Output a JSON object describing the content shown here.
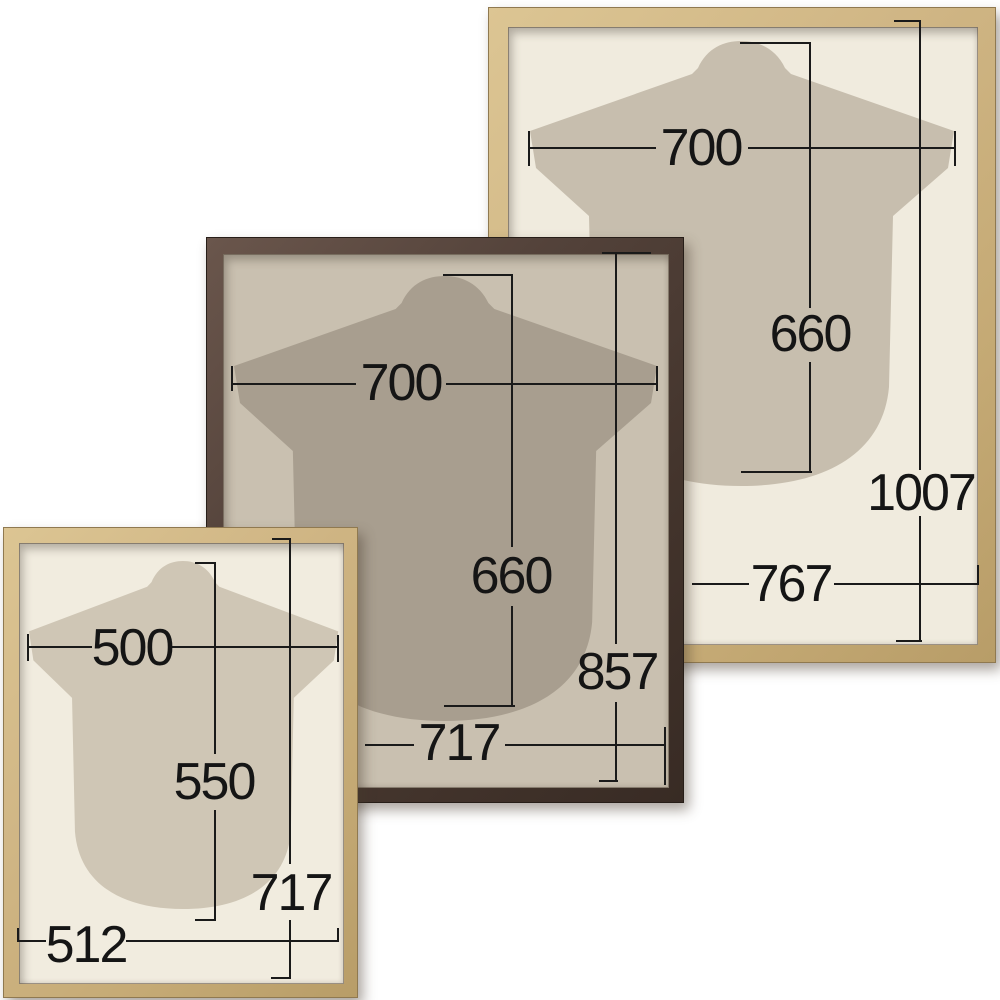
{
  "diagram_title": "Shirt display frame size diagram",
  "background_color": "#ffffff",
  "line_color": "#1a1a1a",
  "frames": [
    {
      "label": "large-natural-wood-frame",
      "finish": "natural wood",
      "wood_color": "#cdb37f",
      "mat_color": "#f0ebde",
      "shirt_color": "#c7beae",
      "dims": {
        "shirt_width": "700",
        "shirt_height": "660",
        "outer_height": "1007",
        "outer_width": "767"
      }
    },
    {
      "label": "medium-dark-brown-frame",
      "finish": "dark brown wood",
      "wood_color": "#4b3b33",
      "mat_color": "#c9c0b0",
      "shirt_color": "#a89e8f",
      "dims": {
        "shirt_width": "700",
        "shirt_height": "660",
        "outer_height": "857",
        "outer_width": "717"
      }
    },
    {
      "label": "small-natural-wood-frame",
      "finish": "natural wood",
      "wood_color": "#cdb584",
      "mat_color": "#f1ecdf",
      "shirt_color": "#cfc6b5",
      "dims": {
        "shirt_width": "500",
        "shirt_height": "550",
        "outer_height": "717",
        "outer_width": "512"
      }
    }
  ]
}
